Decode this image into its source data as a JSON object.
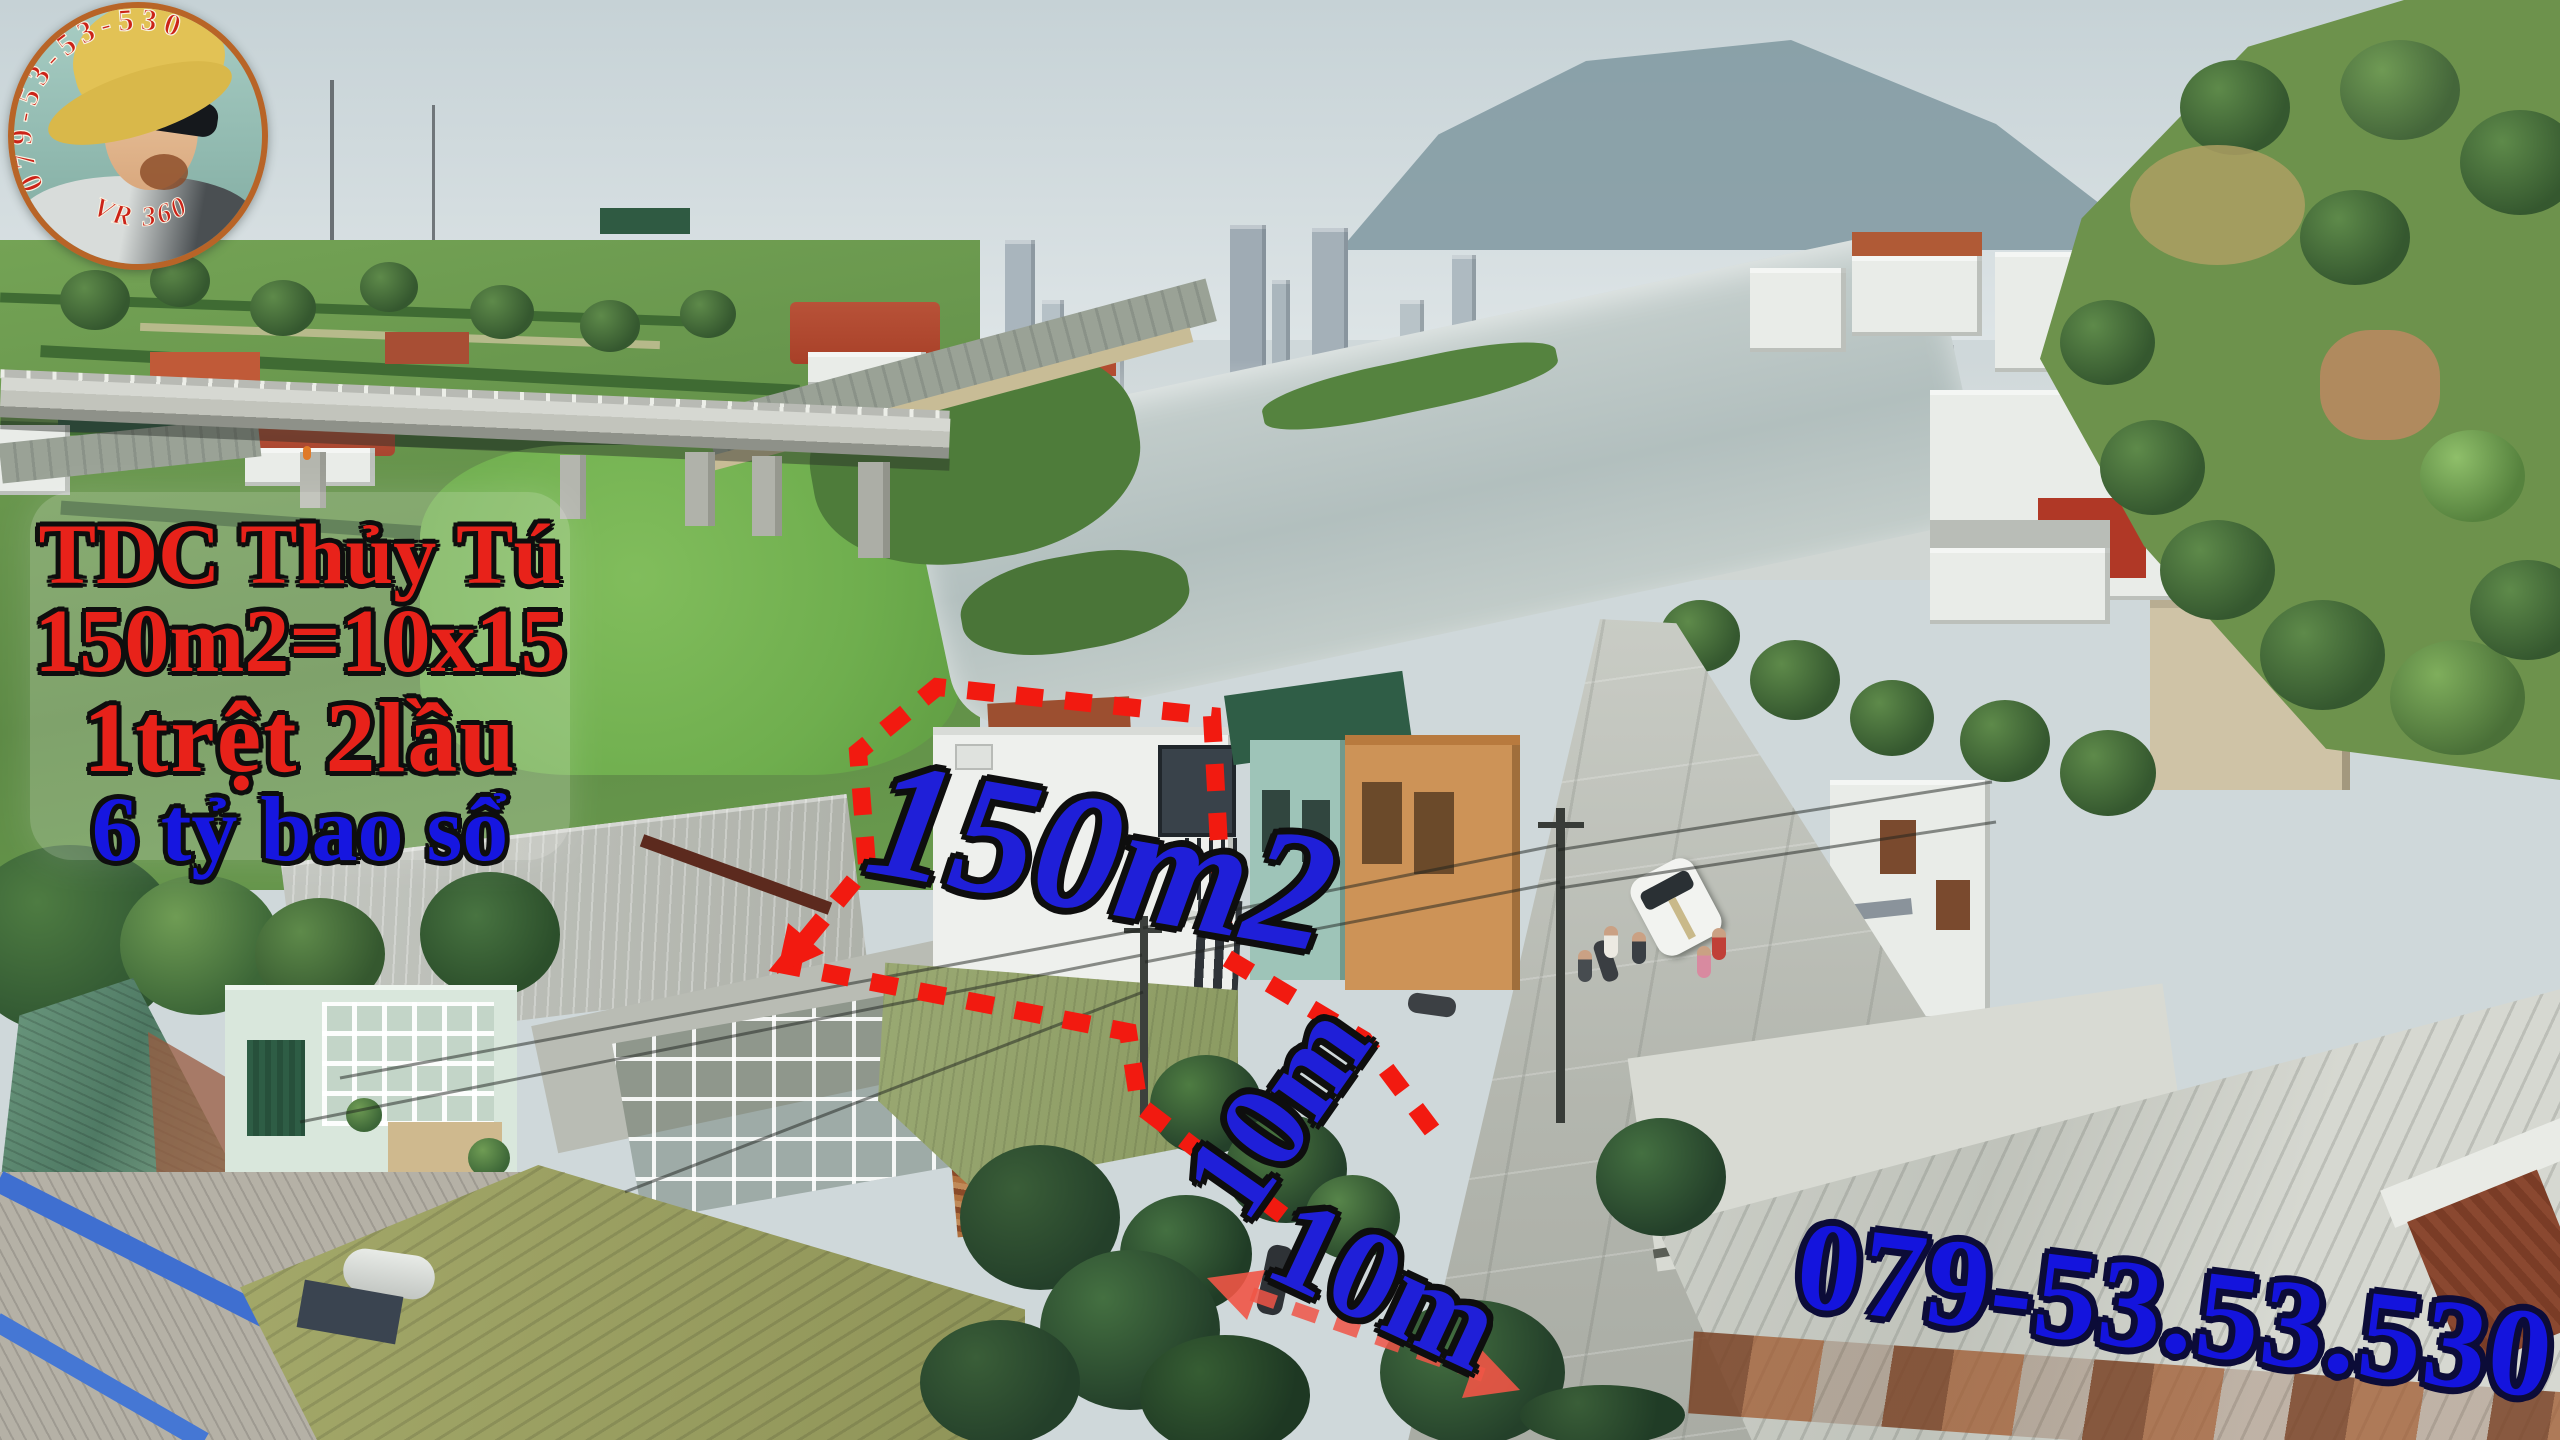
{
  "logo": {
    "phone_arc": "079-53-53-530",
    "vr_label": "VR 360"
  },
  "info_box": {
    "line1": "TDC Thủy Tú",
    "line2": "150m2=10x15",
    "line3": "1trệt 2lầu",
    "line4": "6 tỷ bao sổ"
  },
  "labels": {
    "area": "150m2",
    "frontage_depth": "10m",
    "frontage_width": "10m",
    "phone": "079-53.53.530"
  },
  "colors": {
    "annotation_red": "#f21a10",
    "annotation_blue": "#1f1fd8",
    "info_red": "#e8221a",
    "info_blue": "#1616e0",
    "logo_ring": "#b86427"
  }
}
